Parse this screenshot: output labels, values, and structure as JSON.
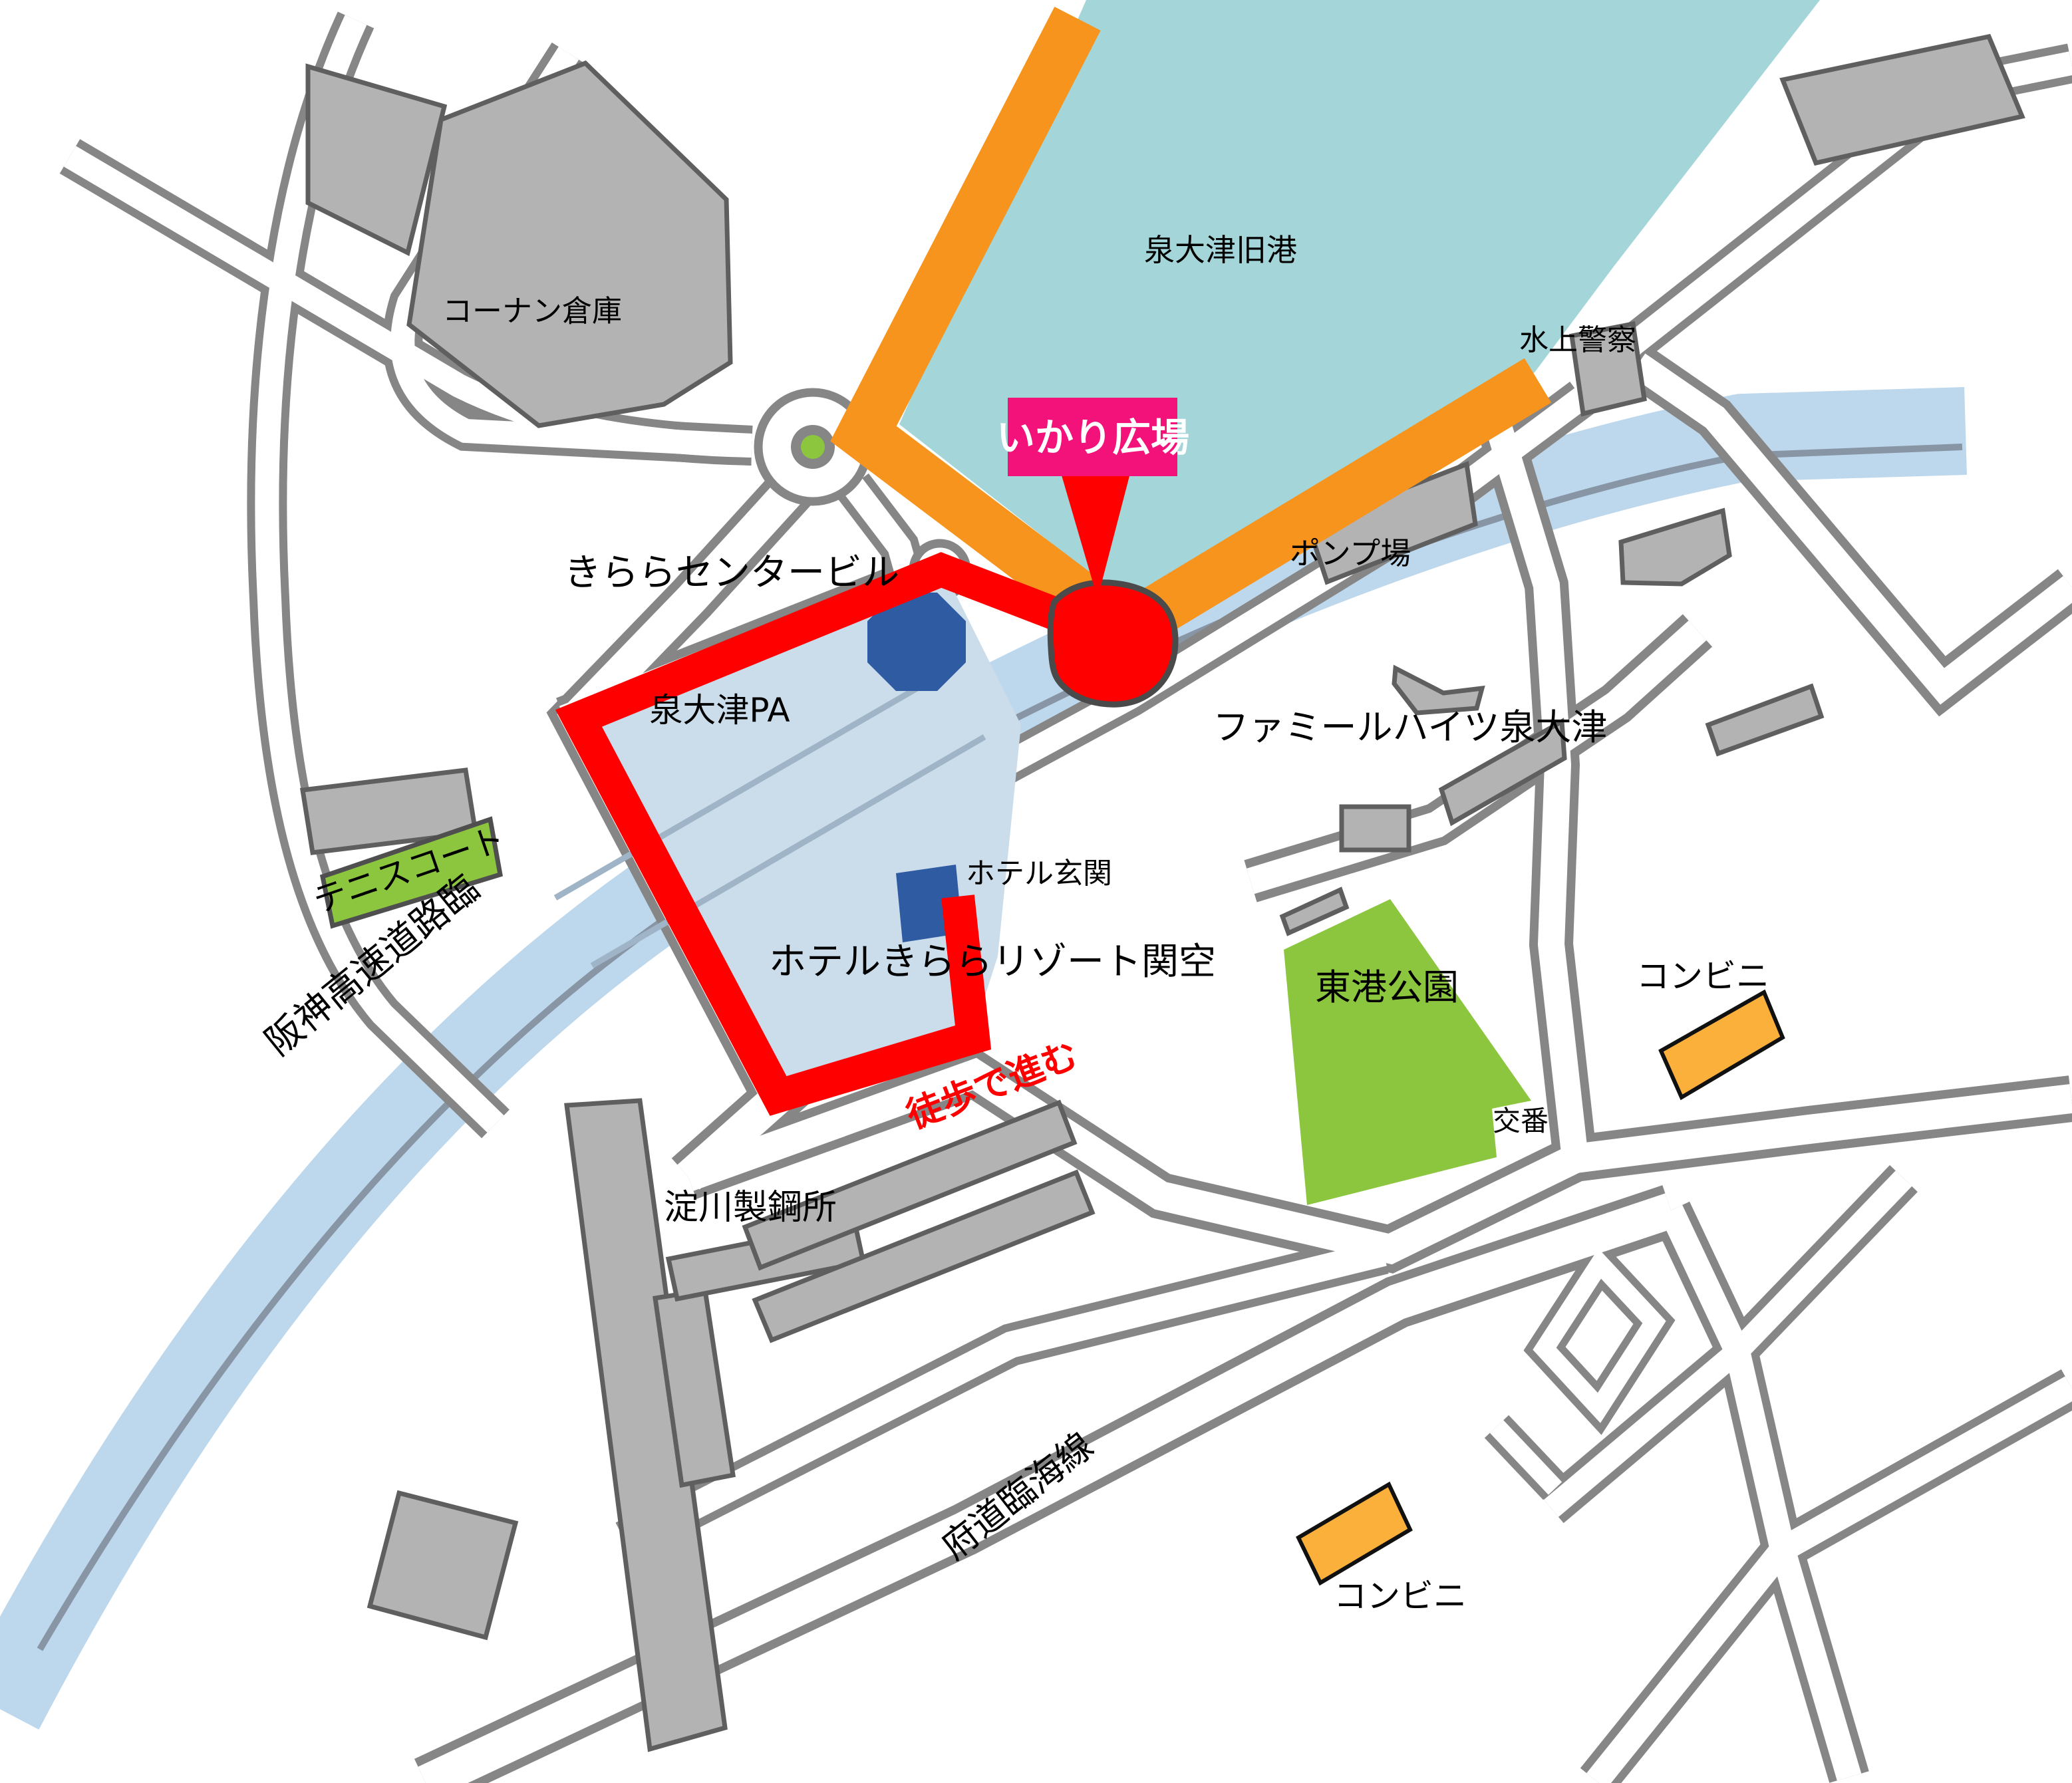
{
  "labels": {
    "harbor": "泉大津旧港",
    "konan_warehouse": "コーナン倉庫",
    "water_police": "水上警察",
    "pump_station": "ポンプ場",
    "kirara_center_bldg": "きららセンタービル",
    "izumiotsu_pa": "泉大津PA",
    "famille_heights": "ファミールハイツ泉大津",
    "hotel_entrance": "ホテル玄関",
    "hotel_kirara_resort": "ホテルきららリゾート関空",
    "tennis_court": "テニスコート",
    "hanshin_expressway": "阪神高速道路臨",
    "yodogawa_steel": "淀川製鋼所",
    "higashiko_park": "東港公園",
    "koban": "交番",
    "convenience_right": "コンビニ",
    "convenience_bottom": "コンビニ",
    "prefectural_rinkai_line": "府道臨海線",
    "walk_note": "徒歩で進む",
    "ikari_plaza_banner": "いかり広場"
  },
  "colors": {
    "water": "#A3D5D9",
    "river": "#BDD7EC",
    "river_line": "#8795A5",
    "road_edge": "#868686",
    "building": "#B3B3B3",
    "route_orange": "#F7941D",
    "route_red": "#FF0000",
    "banner_pink": "#F3117A",
    "park_green": "#8CC63F",
    "shop_orange": "#FBB03B",
    "landmark_blue": "#2F5BA3",
    "pa_block": "#CBDDEB",
    "pa_block_shadow": "#A9BCCB"
  }
}
